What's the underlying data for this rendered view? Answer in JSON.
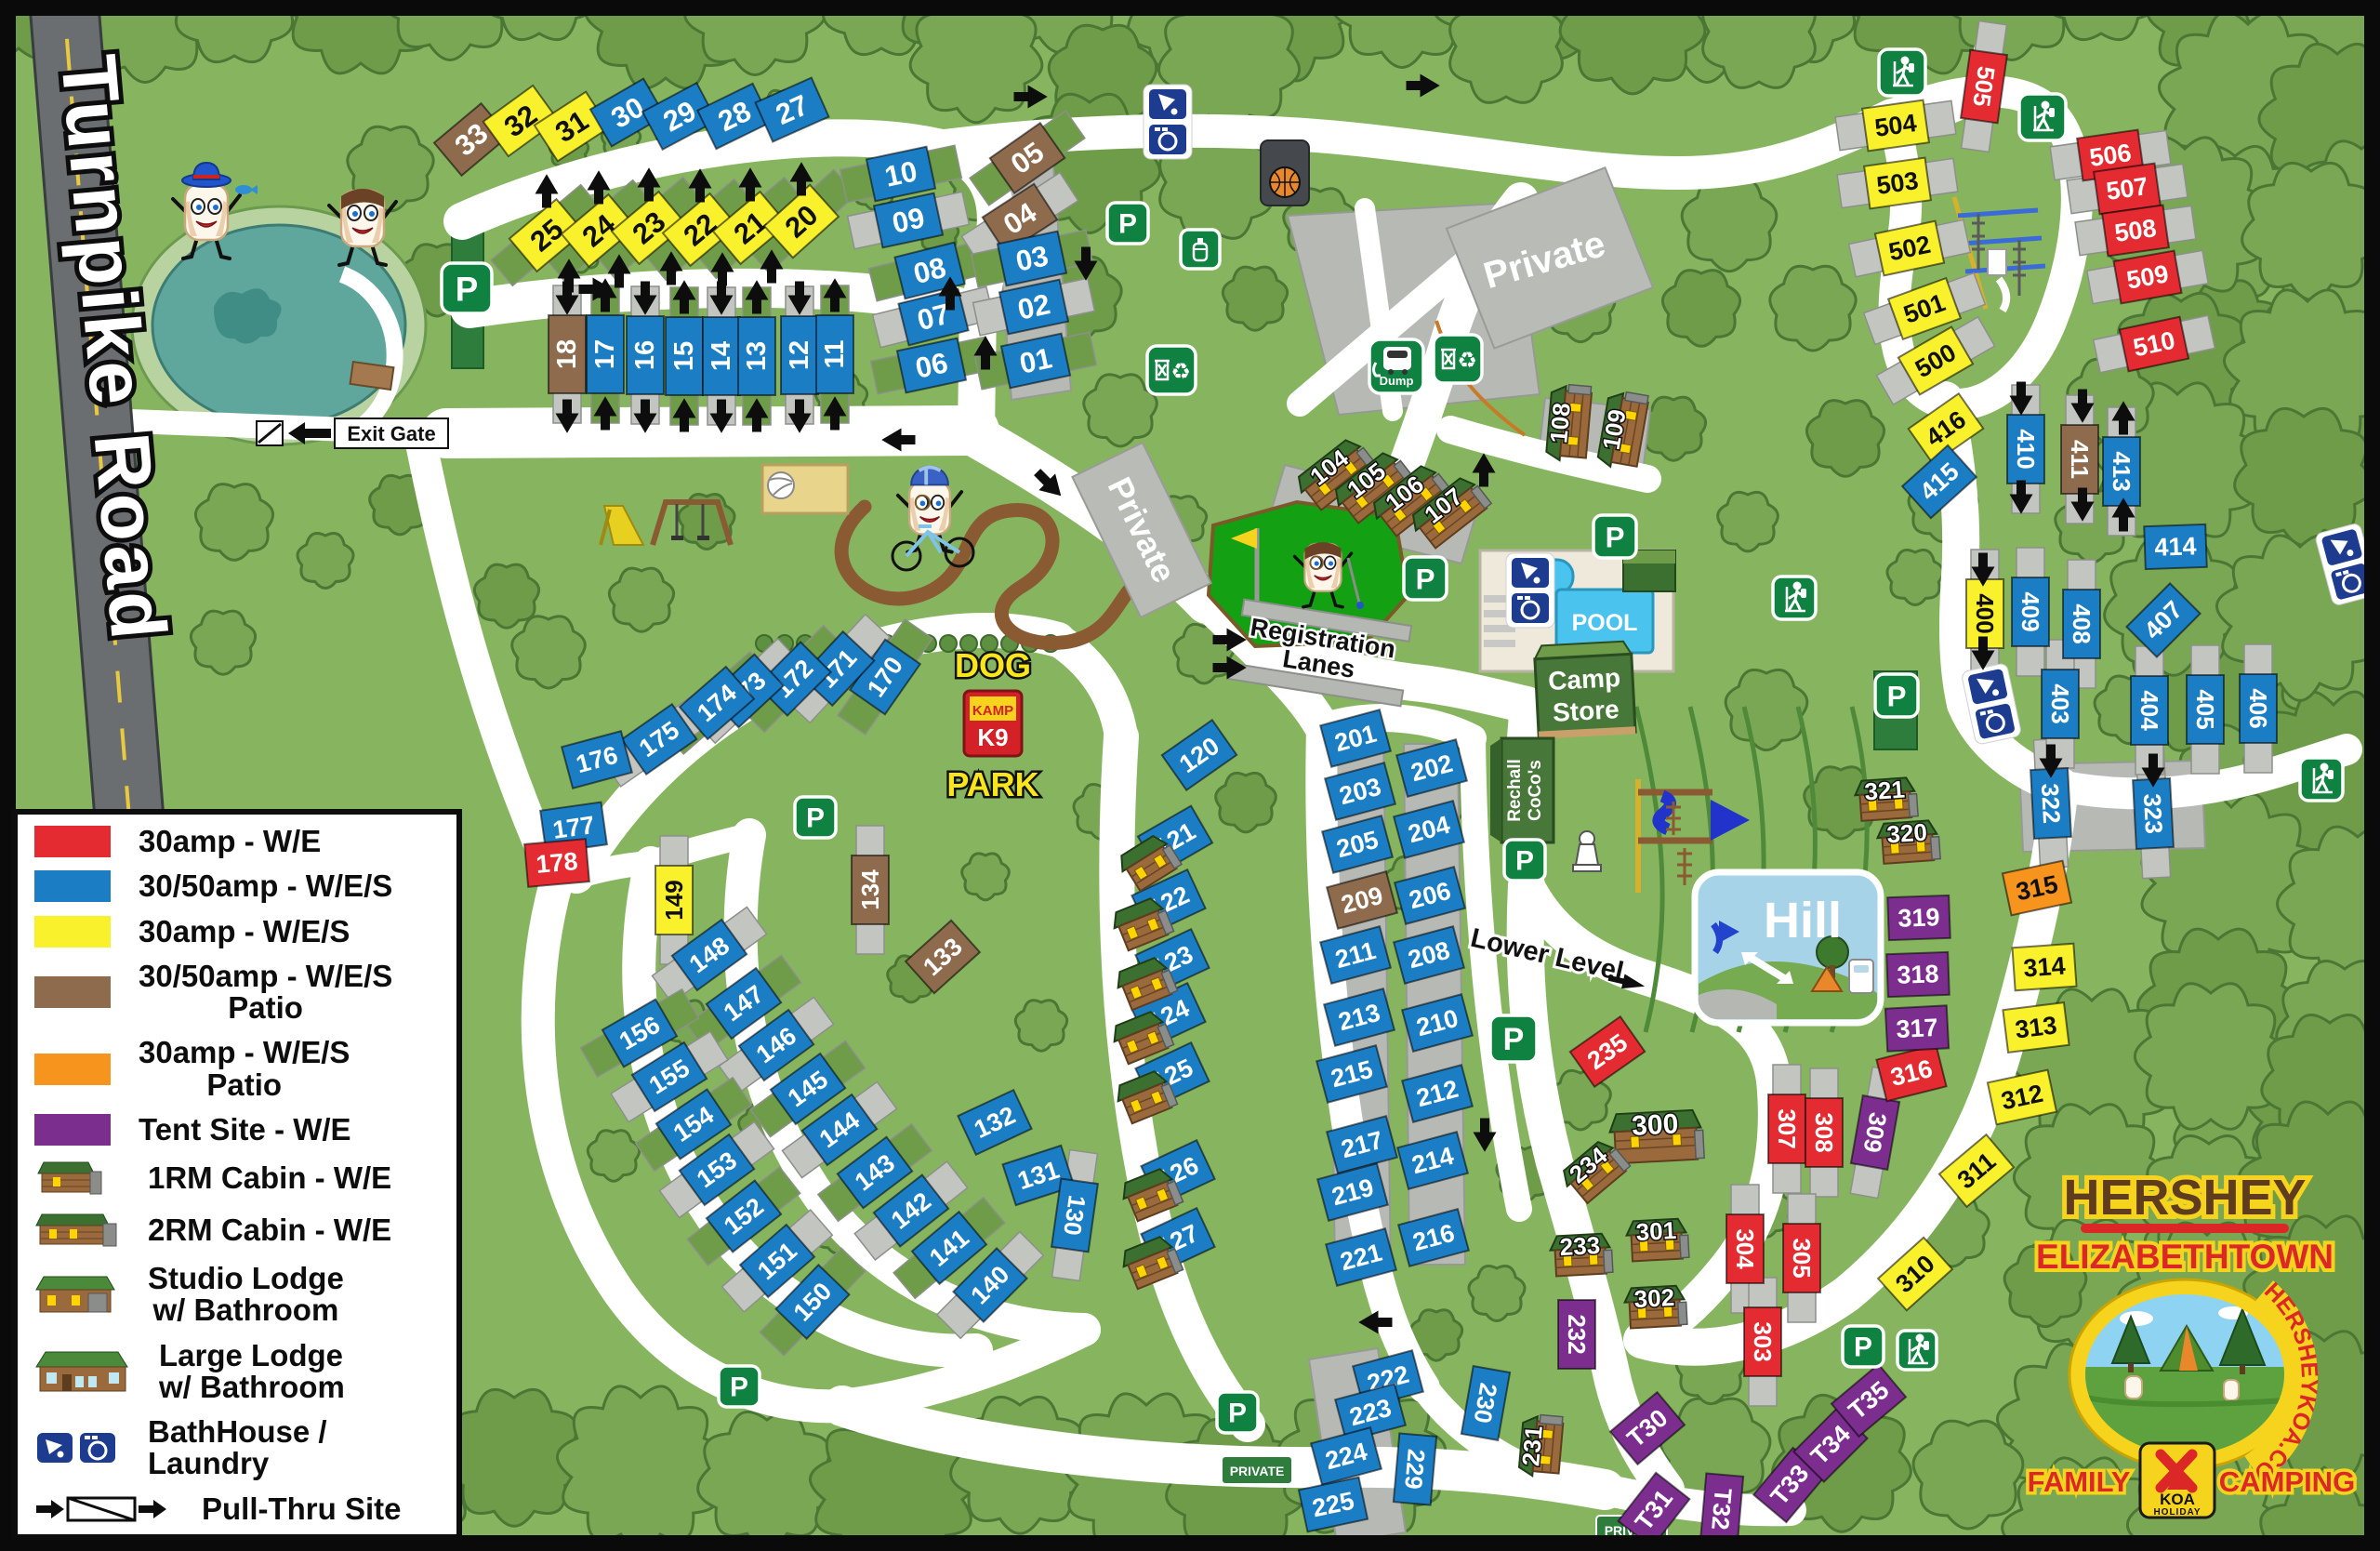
{
  "title": "Hershey Elizabethtown KOA Family Camping Map",
  "colors": {
    "red": "#e42b31",
    "blue": "#1b7ec5",
    "yellow": "#f9f12c",
    "brown": "#8f6b4e",
    "orange": "#f7941d",
    "purple": "#7b2e8e",
    "map_green": "#87b55f",
    "tree_green": "#7aa754",
    "road_white": "#ffffff",
    "icon_green": "#0f8140",
    "icon_blue": "#1d3c8f",
    "pool_blue": "#4ac3ef",
    "golf_green": "#13a013",
    "hill_blue": "#a7d3e8",
    "gray_lot": "#b7bab4"
  },
  "roads": {
    "turnpike": "Turnpike Road",
    "exit_gate": "Exit Gate",
    "registration_1": "Registration",
    "registration_2": "Lanes",
    "lower_level": "Lower Level",
    "private": "Private",
    "private_sign": "PRIVATE"
  },
  "places": {
    "pool": "POOL",
    "camp_store_1": "Camp",
    "camp_store_2": "Store",
    "rec_hall_1": "Rechall",
    "rec_hall_2": "CoCo's",
    "dog_park_top": "DOG",
    "dog_park_bottom": "PARK",
    "kamp": "KAMP",
    "k9": "K9",
    "hill": "Hill",
    "dump": "Dump"
  },
  "logo": {
    "line1": "HERSHEY",
    "line2": "ELIZABETHTOWN",
    "arc": "HERSHEYKOA.COM",
    "family": "FAMILY",
    "camping": "CAMPING",
    "koa": "KOA",
    "holiday": "HOLIDAY"
  },
  "legend": {
    "items": [
      {
        "color": "red",
        "label": "30amp - W/E"
      },
      {
        "color": "blue",
        "label": "30/50amp - W/E/S"
      },
      {
        "color": "yellow",
        "label": "30amp - W/E/S"
      },
      {
        "color": "brown",
        "label": "30/50amp - W/E/S",
        "label2": "Patio"
      },
      {
        "color": "orange",
        "label": "30amp - W/E/S",
        "label2": "Patio"
      },
      {
        "color": "purple",
        "label": "Tent Site - W/E"
      },
      {
        "icon": "cabin-1rm",
        "label": "1RM Cabin - W/E"
      },
      {
        "icon": "cabin-2rm",
        "label": "2RM Cabin - W/E"
      },
      {
        "icon": "studio-lodge",
        "label": "Studio Lodge",
        "label2": "w/ Bathroom"
      },
      {
        "icon": "large-lodge",
        "label": "Large Lodge",
        "label2": "w/ Bathroom"
      },
      {
        "icon": "bathhouse",
        "label": "BathHouse / Laundry"
      },
      {
        "icon": "pull-thru",
        "label": "Pull-Thru Site"
      }
    ]
  },
  "site_fields": [
    "id",
    "color",
    "x",
    "y",
    "rot",
    "vertical",
    "pad"
  ],
  "sites": [
    [
      "33",
      "N",
      507,
      150,
      -40,
      0,
      0
    ],
    [
      "32",
      "Y",
      560,
      130,
      -36,
      0,
      0
    ],
    [
      "31",
      "Y",
      615,
      136,
      -33,
      0,
      0
    ],
    [
      "30",
      "B",
      675,
      121,
      -30,
      0,
      0
    ],
    [
      "29",
      "B",
      731,
      125,
      -28,
      0,
      0
    ],
    [
      "28",
      "B",
      790,
      125,
      -26,
      0,
      0
    ],
    [
      "27",
      "B",
      852,
      118,
      -24,
      0,
      0
    ],
    [
      "25",
      "Y",
      588,
      253,
      -40,
      0,
      1
    ],
    [
      "24",
      "Y",
      644,
      248,
      -40,
      0,
      1
    ],
    [
      "23",
      "Y",
      698,
      245,
      -40,
      0,
      1
    ],
    [
      "22",
      "Y",
      753,
      247,
      -40,
      0,
      1
    ],
    [
      "21",
      "Y",
      807,
      245,
      -40,
      0,
      1
    ],
    [
      "20",
      "Y",
      862,
      238,
      -42,
      0,
      1
    ],
    [
      "18",
      "N",
      610,
      381,
      0,
      1,
      2
    ],
    [
      "17",
      "B",
      651,
      381,
      0,
      1,
      1
    ],
    [
      "16",
      "B",
      694,
      382,
      0,
      1,
      2
    ],
    [
      "15",
      "B",
      736,
      383,
      0,
      1,
      1
    ],
    [
      "14",
      "B",
      776,
      383,
      0,
      1,
      2
    ],
    [
      "13",
      "B",
      814,
      383,
      0,
      1,
      1
    ],
    [
      "12",
      "B",
      860,
      382,
      0,
      1,
      2
    ],
    [
      "11",
      "B",
      898,
      381,
      0,
      1,
      1
    ],
    [
      "10",
      "B",
      969,
      187,
      -12,
      0,
      1
    ],
    [
      "09",
      "B",
      977,
      237,
      -12,
      0,
      2
    ],
    [
      "08",
      "B",
      1000,
      291,
      -14,
      0,
      1
    ],
    [
      "07",
      "B",
      1004,
      341,
      -14,
      0,
      2
    ],
    [
      "06",
      "B",
      1002,
      393,
      -12,
      0,
      1
    ],
    [
      "05",
      "N",
      1105,
      170,
      -35,
      0,
      1
    ],
    [
      "04",
      "N",
      1097,
      235,
      -33,
      0,
      2
    ],
    [
      "03",
      "B",
      1110,
      278,
      -12,
      0,
      1
    ],
    [
      "02",
      "B",
      1112,
      330,
      -12,
      0,
      2
    ],
    [
      "01",
      "B",
      1114,
      388,
      -12,
      0,
      1
    ],
    [
      "170",
      "B",
      952,
      728,
      -55,
      0,
      1
    ],
    [
      "171",
      "B",
      901,
      719,
      -47,
      0,
      2
    ],
    [
      "172",
      "B",
      854,
      730,
      -45,
      0,
      1
    ],
    [
      "173",
      "B",
      803,
      743,
      -43,
      0,
      2
    ],
    [
      "174",
      "B",
      771,
      756,
      -41,
      0,
      1
    ],
    [
      "175",
      "B",
      709,
      795,
      -35,
      0,
      2
    ],
    [
      "176",
      "B",
      642,
      817,
      -15,
      0,
      0
    ],
    [
      "177",
      "B",
      617,
      890,
      -8,
      0,
      0
    ],
    [
      "178",
      "R",
      599,
      928,
      -5,
      0,
      0
    ],
    [
      "149",
      "Y",
      725,
      968,
      0,
      1,
      2
    ],
    [
      "134",
      "N",
      936,
      957,
      0,
      1,
      2
    ],
    [
      "133",
      "N",
      1014,
      1029,
      -42,
      0,
      0
    ],
    [
      "148",
      "B",
      763,
      1027,
      -36,
      0,
      2
    ],
    [
      "147",
      "B",
      800,
      1079,
      -36,
      0,
      1
    ],
    [
      "146",
      "B",
      835,
      1124,
      -36,
      0,
      2
    ],
    [
      "145",
      "B",
      869,
      1171,
      -36,
      0,
      1
    ],
    [
      "144",
      "B",
      903,
      1215,
      -36,
      0,
      2
    ],
    [
      "143",
      "B",
      941,
      1261,
      -37,
      0,
      1
    ],
    [
      "142",
      "B",
      980,
      1302,
      -38,
      0,
      2
    ],
    [
      "141",
      "B",
      1021,
      1342,
      -40,
      0,
      1
    ],
    [
      "140",
      "B",
      1065,
      1382,
      -45,
      0,
      2
    ],
    [
      "156",
      "B",
      688,
      1111,
      -30,
      0,
      1
    ],
    [
      "155",
      "B",
      720,
      1158,
      -32,
      0,
      2
    ],
    [
      "154",
      "B",
      746,
      1209,
      -34,
      0,
      1
    ],
    [
      "153",
      "B",
      771,
      1258,
      -36,
      0,
      2
    ],
    [
      "152",
      "B",
      800,
      1308,
      -38,
      0,
      1
    ],
    [
      "151",
      "B",
      836,
      1356,
      -41,
      0,
      2
    ],
    [
      "150",
      "B",
      874,
      1400,
      -46,
      0,
      1
    ],
    [
      "132",
      "B",
      1070,
      1207,
      -25,
      0,
      0
    ],
    [
      "131",
      "B",
      1117,
      1264,
      -18,
      0,
      0
    ],
    [
      "130",
      "B",
      1156,
      1307,
      8,
      2,
      2
    ],
    [
      "120",
      "B",
      1290,
      812,
      -35,
      0,
      0
    ],
    [
      "121",
      "B",
      1264,
      903,
      -30,
      0,
      0
    ],
    [
      "122",
      "B",
      1257,
      970,
      -25,
      0,
      0
    ],
    [
      "123",
      "B",
      1261,
      1034,
      -25,
      0,
      0
    ],
    [
      "124",
      "B",
      1257,
      1092,
      -25,
      0,
      0
    ],
    [
      "125",
      "B",
      1261,
      1156,
      -25,
      0,
      0
    ],
    [
      "126",
      "B",
      1267,
      1261,
      -25,
      0,
      0
    ],
    [
      "127",
      "B",
      1267,
      1334,
      -25,
      0,
      0
    ],
    [
      "201",
      "B",
      1458,
      794,
      -15,
      0,
      0
    ],
    [
      "202",
      "B",
      1540,
      826,
      -15,
      0,
      0
    ],
    [
      "203",
      "B",
      1463,
      851,
      -15,
      0,
      0
    ],
    [
      "204",
      "B",
      1537,
      892,
      -15,
      0,
      0
    ],
    [
      "205",
      "B",
      1460,
      908,
      -15,
      0,
      0
    ],
    [
      "206",
      "B",
      1538,
      963,
      -15,
      0,
      0
    ],
    [
      "209",
      "N",
      1465,
      968,
      -15,
      0,
      0
    ],
    [
      "208",
      "B",
      1537,
      1027,
      -15,
      0,
      0
    ],
    [
      "211",
      "B",
      1458,
      1027,
      -15,
      0,
      0
    ],
    [
      "210",
      "B",
      1546,
      1100,
      -15,
      0,
      0
    ],
    [
      "213",
      "B",
      1462,
      1094,
      -15,
      0,
      0
    ],
    [
      "212",
      "B",
      1546,
      1176,
      -15,
      0,
      0
    ],
    [
      "215",
      "B",
      1454,
      1155,
      -15,
      0,
      0
    ],
    [
      "214",
      "B",
      1541,
      1248,
      -15,
      0,
      0
    ],
    [
      "217",
      "B",
      1465,
      1231,
      -15,
      0,
      0
    ],
    [
      "216",
      "B",
      1542,
      1331,
      -15,
      0,
      0
    ],
    [
      "219",
      "B",
      1455,
      1282,
      -15,
      0,
      0
    ],
    [
      "221",
      "B",
      1464,
      1352,
      -15,
      0,
      0
    ],
    [
      "222",
      "B",
      1493,
      1483,
      -15,
      0,
      0
    ],
    [
      "223",
      "B",
      1474,
      1519,
      -15,
      0,
      0
    ],
    [
      "224",
      "B",
      1448,
      1566,
      -15,
      0,
      0
    ],
    [
      "225",
      "B",
      1434,
      1618,
      -12,
      0,
      0
    ],
    [
      "229",
      "B",
      1522,
      1580,
      5,
      2,
      0
    ],
    [
      "230",
      "B",
      1598,
      1509,
      10,
      2,
      0
    ],
    [
      "235",
      "R",
      1729,
      1131,
      -35,
      0,
      0
    ],
    [
      "232",
      "P",
      1696,
      1435,
      0,
      2,
      0
    ],
    [
      "307",
      "R",
      1922,
      1214,
      0,
      2,
      2
    ],
    [
      "308",
      "R",
      1962,
      1218,
      0,
      2,
      2
    ],
    [
      "309",
      "P",
      2017,
      1218,
      10,
      2,
      2
    ],
    [
      "304",
      "R",
      1877,
      1343,
      0,
      2,
      2
    ],
    [
      "305",
      "R",
      1938,
      1353,
      0,
      2,
      2
    ],
    [
      "303",
      "R",
      1896,
      1443,
      0,
      2,
      2
    ],
    [
      "T30",
      "P",
      1772,
      1536,
      -40,
      0,
      0
    ],
    [
      "T31",
      "P",
      1779,
      1624,
      -52,
      0,
      0
    ],
    [
      "T32",
      "P",
      1852,
      1623,
      5,
      2,
      0
    ],
    [
      "T33",
      "P",
      1925,
      1597,
      -50,
      0,
      0
    ],
    [
      "T34",
      "P",
      1969,
      1554,
      -45,
      0,
      0
    ],
    [
      "T35",
      "P",
      2010,
      1506,
      -40,
      0,
      0
    ],
    [
      "316",
      "R",
      2056,
      1154,
      -14,
      0,
      0
    ],
    [
      "317",
      "P",
      2062,
      1106,
      -3,
      0,
      0
    ],
    [
      "318",
      "P",
      2063,
      1048,
      -2,
      0,
      0
    ],
    [
      "319",
      "P",
      2064,
      987,
      -2,
      0,
      0
    ],
    [
      "315",
      "O",
      2191,
      955,
      -12,
      0,
      0
    ],
    [
      "314",
      "Y",
      2199,
      1040,
      -4,
      0,
      0
    ],
    [
      "313",
      "Y",
      2190,
      1105,
      -7,
      0,
      0
    ],
    [
      "312",
      "Y",
      2175,
      1180,
      -12,
      0,
      0
    ],
    [
      "311",
      "Y",
      2126,
      1259,
      -40,
      0,
      0
    ],
    [
      "310",
      "Y",
      2060,
      1370,
      -42,
      0,
      0
    ],
    [
      "322",
      "B",
      2206,
      864,
      -3,
      2,
      2
    ],
    [
      "323",
      "B",
      2316,
      875,
      -3,
      2,
      2
    ],
    [
      "416",
      "Y",
      2093,
      461,
      -35,
      0,
      0
    ],
    [
      "415",
      "B",
      2086,
      518,
      -42,
      0,
      0
    ],
    [
      "410",
      "B",
      2179,
      483,
      0,
      2,
      2
    ],
    [
      "411",
      "N",
      2237,
      494,
      0,
      2,
      2
    ],
    [
      "413",
      "B",
      2282,
      507,
      0,
      2,
      2
    ],
    [
      "414",
      "B",
      2340,
      588,
      -2,
      0,
      0
    ],
    [
      "400",
      "Y",
      2135,
      660,
      0,
      2,
      2
    ],
    [
      "409",
      "B",
      2184,
      658,
      0,
      2,
      2
    ],
    [
      "408",
      "B",
      2239,
      671,
      0,
      2,
      2
    ],
    [
      "407",
      "B",
      2327,
      667,
      -45,
      0,
      0
    ],
    [
      "403",
      "B",
      2216,
      757,
      0,
      2,
      2
    ],
    [
      "404",
      "B",
      2312,
      764,
      0,
      2,
      2
    ],
    [
      "405",
      "B",
      2372,
      763,
      0,
      2,
      2
    ],
    [
      "406",
      "B",
      2429,
      762,
      0,
      2,
      2
    ],
    [
      "505",
      "R",
      2134,
      93,
      8,
      2,
      2
    ],
    [
      "504",
      "Y",
      2039,
      135,
      -8,
      0,
      2
    ],
    [
      "503",
      "Y",
      2041,
      197,
      -8,
      0,
      2
    ],
    [
      "502",
      "Y",
      2054,
      267,
      -12,
      0,
      2
    ],
    [
      "501",
      "Y",
      2070,
      332,
      -20,
      0,
      2
    ],
    [
      "500",
      "Y",
      2082,
      388,
      -30,
      0,
      2
    ],
    [
      "506",
      "R",
      2270,
      167,
      -8,
      0,
      2
    ],
    [
      "507",
      "R",
      2288,
      203,
      -8,
      0,
      2
    ],
    [
      "508",
      "R",
      2297,
      248,
      -8,
      0,
      2
    ],
    [
      "509",
      "R",
      2310,
      298,
      -10,
      0,
      2
    ],
    [
      "510",
      "R",
      2317,
      370,
      -12,
      0,
      2
    ]
  ],
  "cabin_fields": [
    "id",
    "x",
    "y",
    "rot",
    "style"
  ],
  "cabins": [
    [
      "104",
      1437,
      512,
      -38,
      "c2"
    ],
    [
      "105",
      1477,
      526,
      -38,
      "c2"
    ],
    [
      "106",
      1518,
      540,
      -38,
      "c2"
    ],
    [
      "107",
      1560,
      553,
      -38,
      "c2"
    ],
    [
      "108",
      1690,
      456,
      -85,
      "c2"
    ],
    [
      "109",
      1748,
      464,
      -80,
      "c2"
    ],
    [
      "321",
      2028,
      862,
      -4,
      "c1"
    ],
    [
      "320",
      2052,
      908,
      -4,
      "c1"
    ],
    [
      "300",
      1781,
      1224,
      -3,
      "lg"
    ],
    [
      "301",
      1782,
      1336,
      -3,
      "c1"
    ],
    [
      "302",
      1780,
      1408,
      -3,
      "c1"
    ],
    [
      "233",
      1700,
      1352,
      -3,
      "c1"
    ],
    [
      "234",
      1716,
      1262,
      -40,
      "c1"
    ],
    [
      "231",
      1660,
      1556,
      -85,
      "c1"
    ],
    [
      "",
      1236,
      930,
      -32,
      "p"
    ],
    [
      "",
      1228,
      996,
      -22,
      "p"
    ],
    [
      "",
      1232,
      1060,
      -22,
      "p"
    ],
    [
      "",
      1228,
      1118,
      -22,
      "p"
    ],
    [
      "",
      1232,
      1182,
      -22,
      "p"
    ],
    [
      "",
      1238,
      1287,
      -22,
      "p"
    ],
    [
      "",
      1238,
      1360,
      -22,
      "p"
    ]
  ],
  "icon_fields": [
    "kind",
    "x",
    "y",
    "size",
    "rot"
  ],
  "icons": [
    [
      "P",
      502,
      310,
      54,
      0
    ],
    [
      "P",
      1213,
      240,
      44,
      0
    ],
    [
      "P",
      1533,
      622,
      46,
      0
    ],
    [
      "P",
      1737,
      577,
      46,
      0
    ],
    [
      "P",
      1640,
      925,
      44,
      0
    ],
    [
      "P",
      1628,
      1117,
      50,
      0
    ],
    [
      "P",
      877,
      879,
      44,
      0
    ],
    [
      "P",
      795,
      1491,
      44,
      0
    ],
    [
      "P",
      1331,
      1519,
      44,
      0
    ],
    [
      "P",
      2040,
      748,
      46,
      0
    ],
    [
      "P",
      2004,
      1448,
      44,
      0
    ],
    [
      "BH",
      1256,
      131,
      46,
      0
    ],
    [
      "BH",
      1646,
      635,
      46,
      0
    ],
    [
      "BH",
      2142,
      757,
      44,
      -12
    ],
    [
      "BH",
      2524,
      607,
      44,
      -15
    ],
    [
      "HK",
      2046,
      78,
      50,
      0
    ],
    [
      "HK",
      2197,
      126,
      50,
      0
    ],
    [
      "HK",
      1930,
      643,
      46,
      0
    ],
    [
      "HK",
      2497,
      838,
      46,
      0
    ],
    [
      "HK",
      2062,
      1452,
      42,
      0
    ],
    [
      "DU",
      1502,
      394,
      58,
      0
    ],
    [
      "RC",
      1568,
      386,
      52,
      0
    ],
    [
      "RC",
      1260,
      398,
      52,
      0
    ],
    [
      "PR",
      1291,
      268,
      42,
      0
    ],
    [
      "BB",
      1382,
      186,
      56,
      0
    ],
    [
      "PW",
      1707,
      914,
      40,
      0
    ]
  ]
}
